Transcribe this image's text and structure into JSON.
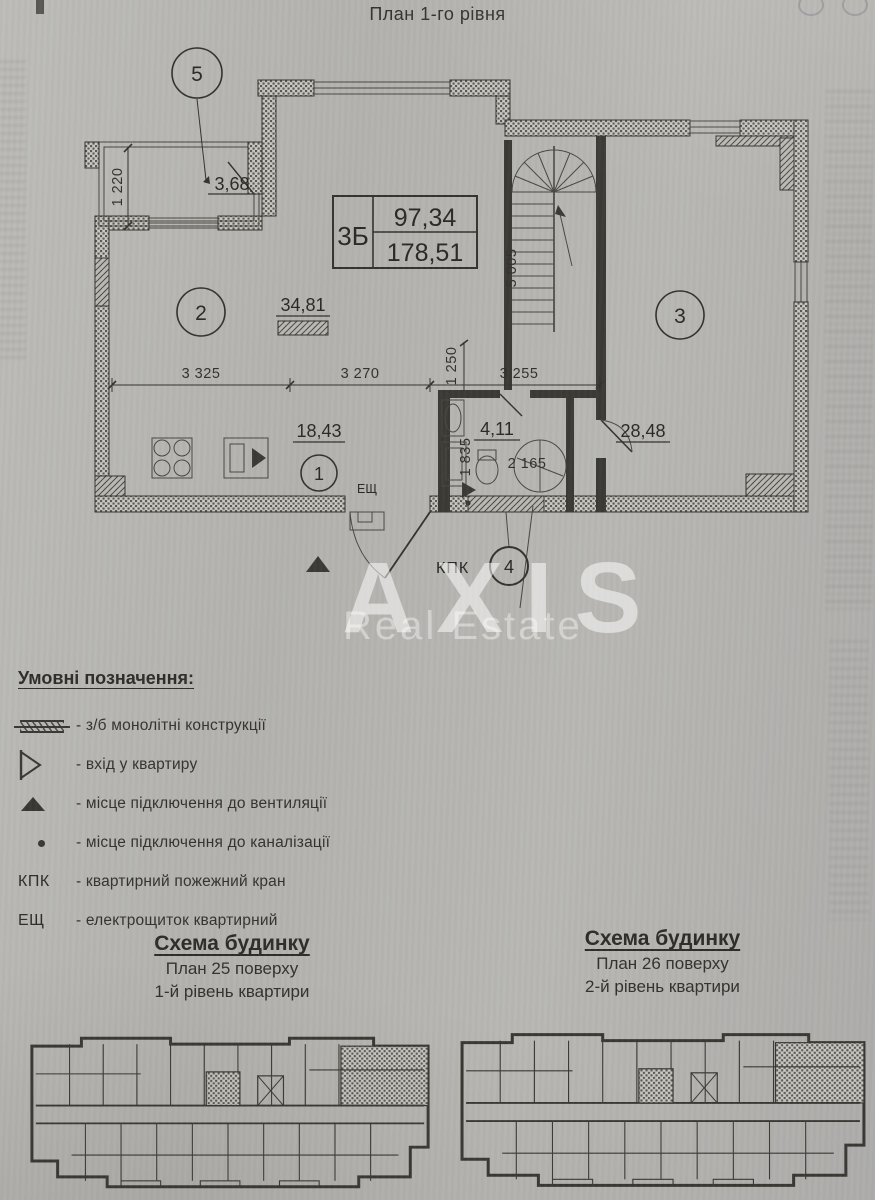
{
  "page": {
    "title": "План 1-го рівня"
  },
  "plan": {
    "unit": {
      "label": "3Б",
      "area_upper": "97,34",
      "area_lower": "178,51"
    },
    "rooms": [
      {
        "n": "1",
        "area": "18,43"
      },
      {
        "n": "2",
        "area": "34,81"
      },
      {
        "n": "3",
        "area": "28,48"
      },
      {
        "n": "4",
        "area": "4,11"
      },
      {
        "n": "5",
        "area": "3,68"
      }
    ],
    "marks": {
      "kpk": "КПК",
      "esh": "ЕЩ"
    },
    "dims": {
      "v1220": "1 220",
      "h3325": "3 325",
      "h3270": "3 270",
      "v1250": "1 250",
      "h3255": "3 255",
      "v5005": "5 005",
      "v1835": "1 835",
      "h2165": "2 165"
    }
  },
  "watermark": {
    "line1": "AXIS",
    "line2": "Real Estate"
  },
  "legend": {
    "title": "Умовні позначення:",
    "items": [
      {
        "symbol": "concrete-hatch",
        "text": "- з/б монолітні конструкції"
      },
      {
        "symbol": "entrance-triangle",
        "text": "- вхід у квартиру"
      },
      {
        "symbol": "vent-triangle",
        "text": "- місце підключення до вентиляції"
      },
      {
        "symbol": "sewage-dot",
        "text": "- місце підключення до каналізації"
      },
      {
        "symbol": "КПК",
        "text": "- квартирний пожежний кран"
      },
      {
        "symbol": "ЕЩ",
        "text": "- електрощиток квартирний"
      }
    ]
  },
  "schemes": [
    {
      "title": "Схема будинку",
      "line1": "План 25 поверху",
      "line2": "1-й рівень квартири"
    },
    {
      "title": "Схема будинку",
      "line1": "План 26 поверху",
      "line2": "2-й рівень квартири"
    }
  ],
  "colors": {
    "paper": "#b6b5b1",
    "ink": "#2b2a27",
    "watermark": "#ffffff"
  }
}
